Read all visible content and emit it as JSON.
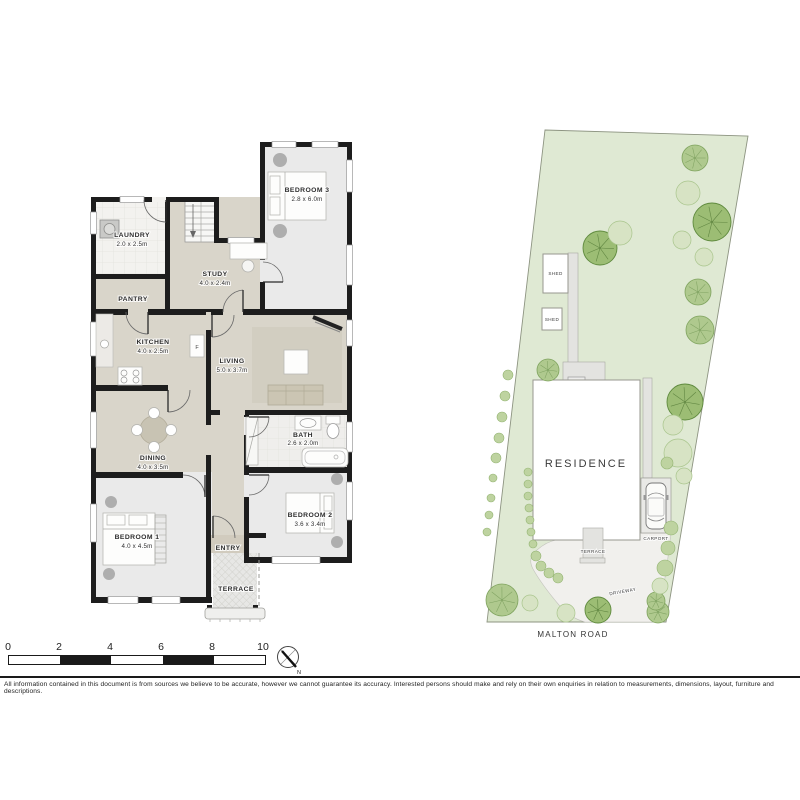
{
  "floor_plan": {
    "rooms": [
      {
        "name": "LAUNDRY",
        "dims": "2.0 x 2.5m"
      },
      {
        "name": "PANTRY",
        "dims": ""
      },
      {
        "name": "STUDY",
        "dims": "4.0 x 2.4m"
      },
      {
        "name": "BEDROOM 3",
        "dims": "2.8 x 6.0m"
      },
      {
        "name": "KITCHEN",
        "dims": "4.0 x 2.5m"
      },
      {
        "name": "LIVING",
        "dims": "5.0 x 3.7m"
      },
      {
        "name": "DINING",
        "dims": "4.0 x 3.5m"
      },
      {
        "name": "BATH",
        "dims": "2.6 x 2.0m"
      },
      {
        "name": "BEDROOM 1",
        "dims": "4.0 x 4.5m"
      },
      {
        "name": "BEDROOM 2",
        "dims": "3.6 x 3.4m"
      },
      {
        "name": "ENTRY",
        "dims": ""
      },
      {
        "name": "TERRACE",
        "dims": ""
      }
    ],
    "fridge_label": "F"
  },
  "site_plan": {
    "residence_label": "RESIDENCE",
    "shed1_label": "SHED",
    "shed2_label": "SHED",
    "terrace_label": "TERRACE",
    "carport_label": "CARPORT",
    "driveway_label": "DRIVEWAY",
    "road_label": "MALTON ROAD",
    "trees": [
      {
        "x": 215,
        "y": 33,
        "r": 13,
        "t": "medium"
      },
      {
        "x": 232,
        "y": 97,
        "r": 19,
        "t": "dark"
      },
      {
        "x": 120,
        "y": 123,
        "r": 17,
        "t": "dark"
      },
      {
        "x": 218,
        "y": 167,
        "r": 13,
        "t": "medium"
      },
      {
        "x": 220,
        "y": 205,
        "r": 14,
        "t": "medium"
      },
      {
        "x": 68,
        "y": 245,
        "r": 11,
        "t": "medium"
      },
      {
        "x": 205,
        "y": 277,
        "r": 18,
        "t": "dark"
      },
      {
        "x": 118,
        "y": 485,
        "r": 13,
        "t": "dark"
      },
      {
        "x": 22,
        "y": 475,
        "r": 16,
        "t": "medium"
      },
      {
        "x": 178,
        "y": 487,
        "r": 11,
        "t": "medium"
      },
      {
        "x": 176,
        "y": 476,
        "r": 9,
        "t": "medium"
      },
      {
        "x": 208,
        "y": 68,
        "r": 12,
        "t": "light"
      },
      {
        "x": 140,
        "y": 108,
        "r": 12,
        "t": "light"
      },
      {
        "x": 202,
        "y": 115,
        "r": 9,
        "t": "light"
      },
      {
        "x": 224,
        "y": 132,
        "r": 9,
        "t": "light"
      },
      {
        "x": 193,
        "y": 300,
        "r": 10,
        "t": "light"
      },
      {
        "x": 198,
        "y": 328,
        "r": 14,
        "t": "light"
      },
      {
        "x": 204,
        "y": 351,
        "r": 8,
        "t": "light"
      },
      {
        "x": 50,
        "y": 478,
        "r": 8,
        "t": "light"
      },
      {
        "x": 86,
        "y": 488,
        "r": 9,
        "t": "light"
      },
      {
        "x": 180,
        "y": 461,
        "r": 8,
        "t": "light"
      },
      {
        "x": 187,
        "y": 338,
        "r": 6,
        "t": "bush"
      },
      {
        "x": 191,
        "y": 403,
        "r": 7,
        "t": "bush"
      },
      {
        "x": 188,
        "y": 423,
        "r": 7,
        "t": "bush"
      },
      {
        "x": 185,
        "y": 443,
        "r": 8,
        "t": "bush"
      },
      {
        "x": 28,
        "y": 250,
        "r": 5,
        "t": "bush"
      },
      {
        "x": 25,
        "y": 271,
        "r": 5,
        "t": "bush"
      },
      {
        "x": 22,
        "y": 292,
        "r": 5,
        "t": "bush"
      },
      {
        "x": 19,
        "y": 313,
        "r": 5,
        "t": "bush"
      },
      {
        "x": 16,
        "y": 333,
        "r": 5,
        "t": "bush"
      },
      {
        "x": 13,
        "y": 353,
        "r": 4,
        "t": "bush"
      },
      {
        "x": 11,
        "y": 373,
        "r": 4,
        "t": "bush"
      },
      {
        "x": 9,
        "y": 390,
        "r": 4,
        "t": "bush"
      },
      {
        "x": 7,
        "y": 407,
        "r": 4,
        "t": "bush"
      },
      {
        "x": 48,
        "y": 347,
        "r": 4,
        "t": "bush"
      },
      {
        "x": 48,
        "y": 359,
        "r": 4,
        "t": "bush"
      },
      {
        "x": 48,
        "y": 371,
        "r": 4,
        "t": "bush"
      },
      {
        "x": 49,
        "y": 383,
        "r": 4,
        "t": "bush"
      },
      {
        "x": 50,
        "y": 395,
        "r": 4,
        "t": "bush"
      },
      {
        "x": 51,
        "y": 407,
        "r": 4,
        "t": "bush"
      },
      {
        "x": 53,
        "y": 419,
        "r": 4,
        "t": "bush"
      },
      {
        "x": 56,
        "y": 431,
        "r": 5,
        "t": "bush"
      },
      {
        "x": 61,
        "y": 441,
        "r": 5,
        "t": "bush"
      },
      {
        "x": 69,
        "y": 448,
        "r": 5,
        "t": "bush"
      },
      {
        "x": 78,
        "y": 453,
        "r": 5,
        "t": "bush"
      }
    ]
  },
  "scale_bar": {
    "labels": [
      "0",
      "2",
      "4",
      "6",
      "8",
      "10"
    ]
  },
  "compass": {
    "north_label": "N"
  },
  "disclaimer": "All information contained in this document is from sources we believe to be accurate, however we cannot guarantee its accuracy. Interested persons should make and rely on their own enquiries in relation to measurements, dimensions, layout, furniture and descriptions.",
  "colors": {
    "wall": "#1d1d1d",
    "floor_beige": "#d9d5ca",
    "floor_gray": "#eaeaea",
    "site_green": "#dfe9d3",
    "tree_dark": "#9cbd74",
    "tree_light": "#d7e3c4"
  }
}
